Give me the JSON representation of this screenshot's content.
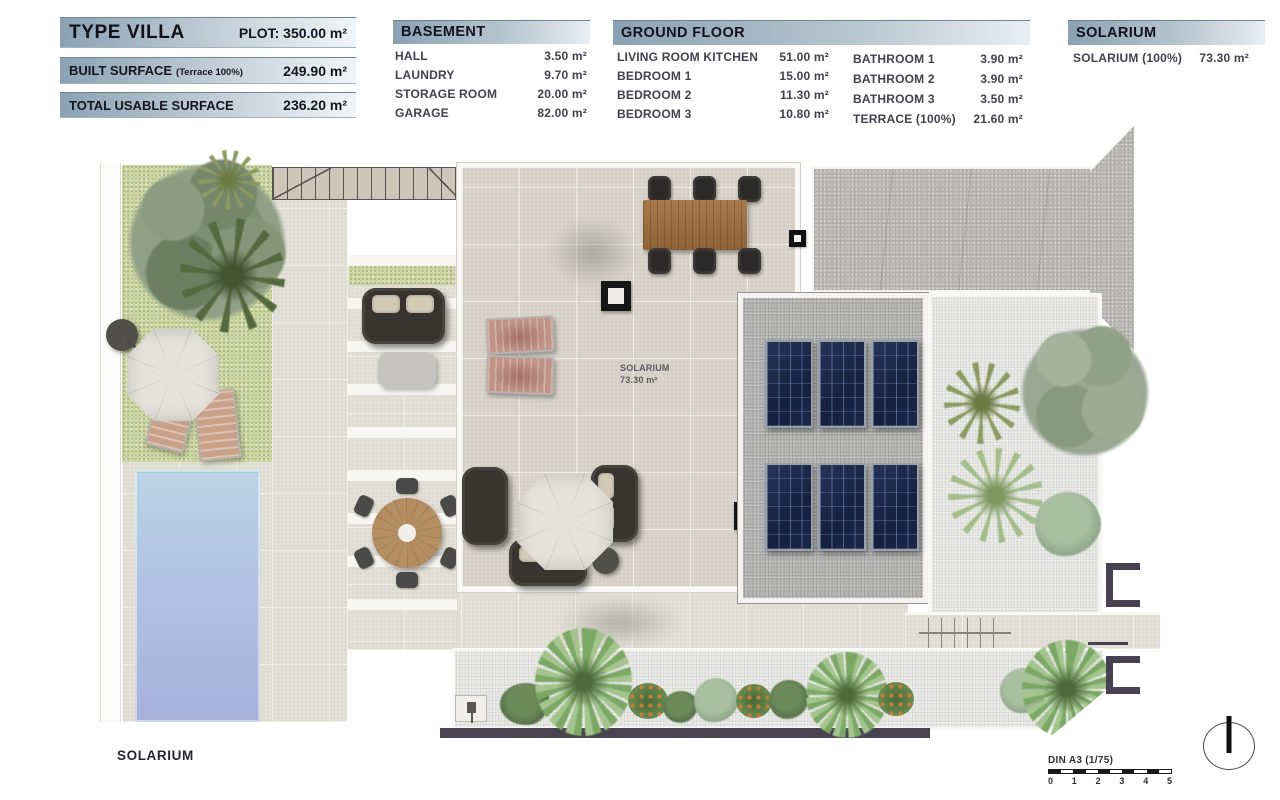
{
  "summary": {
    "type_villa": {
      "title": "TYPE VILLA",
      "plot": "PLOT: 350.00 m²"
    },
    "built_surface": {
      "label": "BUILT SURFACE",
      "note": "(Terrace 100%)",
      "value": "249.90 m²"
    },
    "total_usable": {
      "label": "TOTAL USABLE SURFACE",
      "value": "236.20 m²"
    }
  },
  "basement": {
    "title": "BASEMENT",
    "rows": [
      {
        "label": "HALL",
        "value": "3.50 m²"
      },
      {
        "label": "LAUNDRY",
        "value": "9.70 m²"
      },
      {
        "label": "STORAGE ROOM",
        "value": "20.00 m²"
      },
      {
        "label": "GARAGE",
        "value": "82.00 m²"
      }
    ]
  },
  "ground_floor": {
    "title": "GROUND FLOOR",
    "left": [
      {
        "label": "LIVING ROOM KITCHEN",
        "value": "51.00 m²"
      },
      {
        "label": "BEDROOM 1",
        "value": "15.00 m²"
      },
      {
        "label": "BEDROOM 2",
        "value": "11.30 m²"
      },
      {
        "label": "BEDROOM 3",
        "value": "10.80 m²"
      }
    ],
    "right": [
      {
        "label": "BATHROOM 1",
        "value": "3.90 m²"
      },
      {
        "label": "BATHROOM 2",
        "value": "3.90 m²"
      },
      {
        "label": "BATHROOM 3",
        "value": "3.50 m²"
      },
      {
        "label": "TERRACE (100%)",
        "value": "21.60 m²"
      }
    ]
  },
  "solarium_table": {
    "title": "SOLARIUM",
    "row": {
      "label": "SOLARIUM (100%)",
      "value": "73.30 m²"
    }
  },
  "plan": {
    "area_label": {
      "name": "SOLARIUM",
      "area": "73.30 m²"
    },
    "floor_caption": "SOLARIUM",
    "scale": {
      "label": "DIN A3 (1/75)",
      "ticks": [
        "0",
        "1",
        "2",
        "3",
        "4",
        "5"
      ]
    }
  },
  "colors": {
    "header_start": "#8ba1b2",
    "header_end": "#eef2f5",
    "grass": "#ccd5a1",
    "pool_top": "#bdd3e6",
    "pool_bottom": "#a7b2dc",
    "panel_navy": "#1b2747",
    "wall_dark": "#4a4450"
  }
}
